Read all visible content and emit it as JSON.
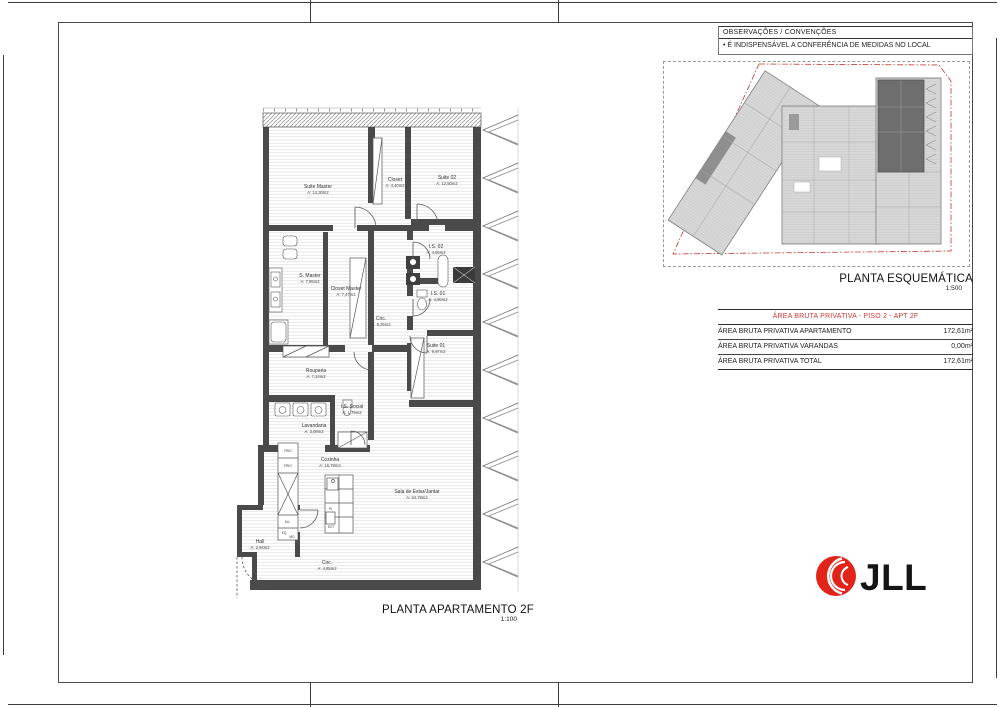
{
  "colors": {
    "accent_red": "#cc3a33",
    "logo_red": "#e2231a",
    "wall_gray": "#4a4a4a"
  },
  "observations": {
    "title": "OBSERVAÇÕES / CONVENÇÕES",
    "note": "• É INDISPENSÁVEL A CONFERÊNCIA DE MEDIDAS NO LOCAL"
  },
  "schematic": {
    "title": "PLANTA ESQUEMÁTICA",
    "scale": "1:500"
  },
  "area_table": {
    "title": "ÁREA BRUTA PRIVATIVA - PISO 2 - APT 2F",
    "rows": [
      {
        "label": "ÁREA BRUTA PRIVATIVA APARTAMENTO",
        "value": "172,61m²"
      },
      {
        "label": "ÁREA BRUTA PRIVATIVA VARANDAS",
        "value": "0,00m²"
      },
      {
        "label": "ÁREA BRUTA PRIVATIVA TOTAL",
        "value": "172,61m²"
      }
    ]
  },
  "plan": {
    "title": "PLANTA APARTAMENTO 2F",
    "scale": "1:100",
    "rooms": [
      {
        "name": "Suite Master",
        "area": "A: 14,30m2"
      },
      {
        "name": "Closet",
        "area": "A: 4,40m2"
      },
      {
        "name": "Suite 02",
        "area": "A: 12,50m2"
      },
      {
        "name": "S. Master",
        "area": "A: 7,85m2"
      },
      {
        "name": "Closet Master",
        "area": "A: 7,47m2"
      },
      {
        "name": "I.S. 02",
        "area": "A: 4,65m2"
      },
      {
        "name": "I.S. 01",
        "area": "A: 4,96m2"
      },
      {
        "name": "Circ.",
        "area": "A: 8,25m2"
      },
      {
        "name": "Suite 01",
        "area": "A: 9,97m2"
      },
      {
        "name": "Rouparia",
        "area": "A: 7,24m2"
      },
      {
        "name": "I.S. Social",
        "area": "A: 1,79m2"
      },
      {
        "name": "Lavandaria",
        "area": "A: 3,08m2"
      },
      {
        "name": "Cozinha",
        "area": "A: 16,78m2"
      },
      {
        "name": "Sala de Estar/Jantar",
        "area": "A: 34,78m2"
      },
      {
        "name": "Hall",
        "area": "A: 2,94m2"
      },
      {
        "name": "Circ.",
        "area": "A: 4,85m2"
      }
    ],
    "labels": [
      "FRIG",
      "FRIG",
      "M.L.",
      "EQ",
      "MO",
      "P.I.",
      "EXT"
    ]
  },
  "logo": {
    "text": "JLL"
  }
}
